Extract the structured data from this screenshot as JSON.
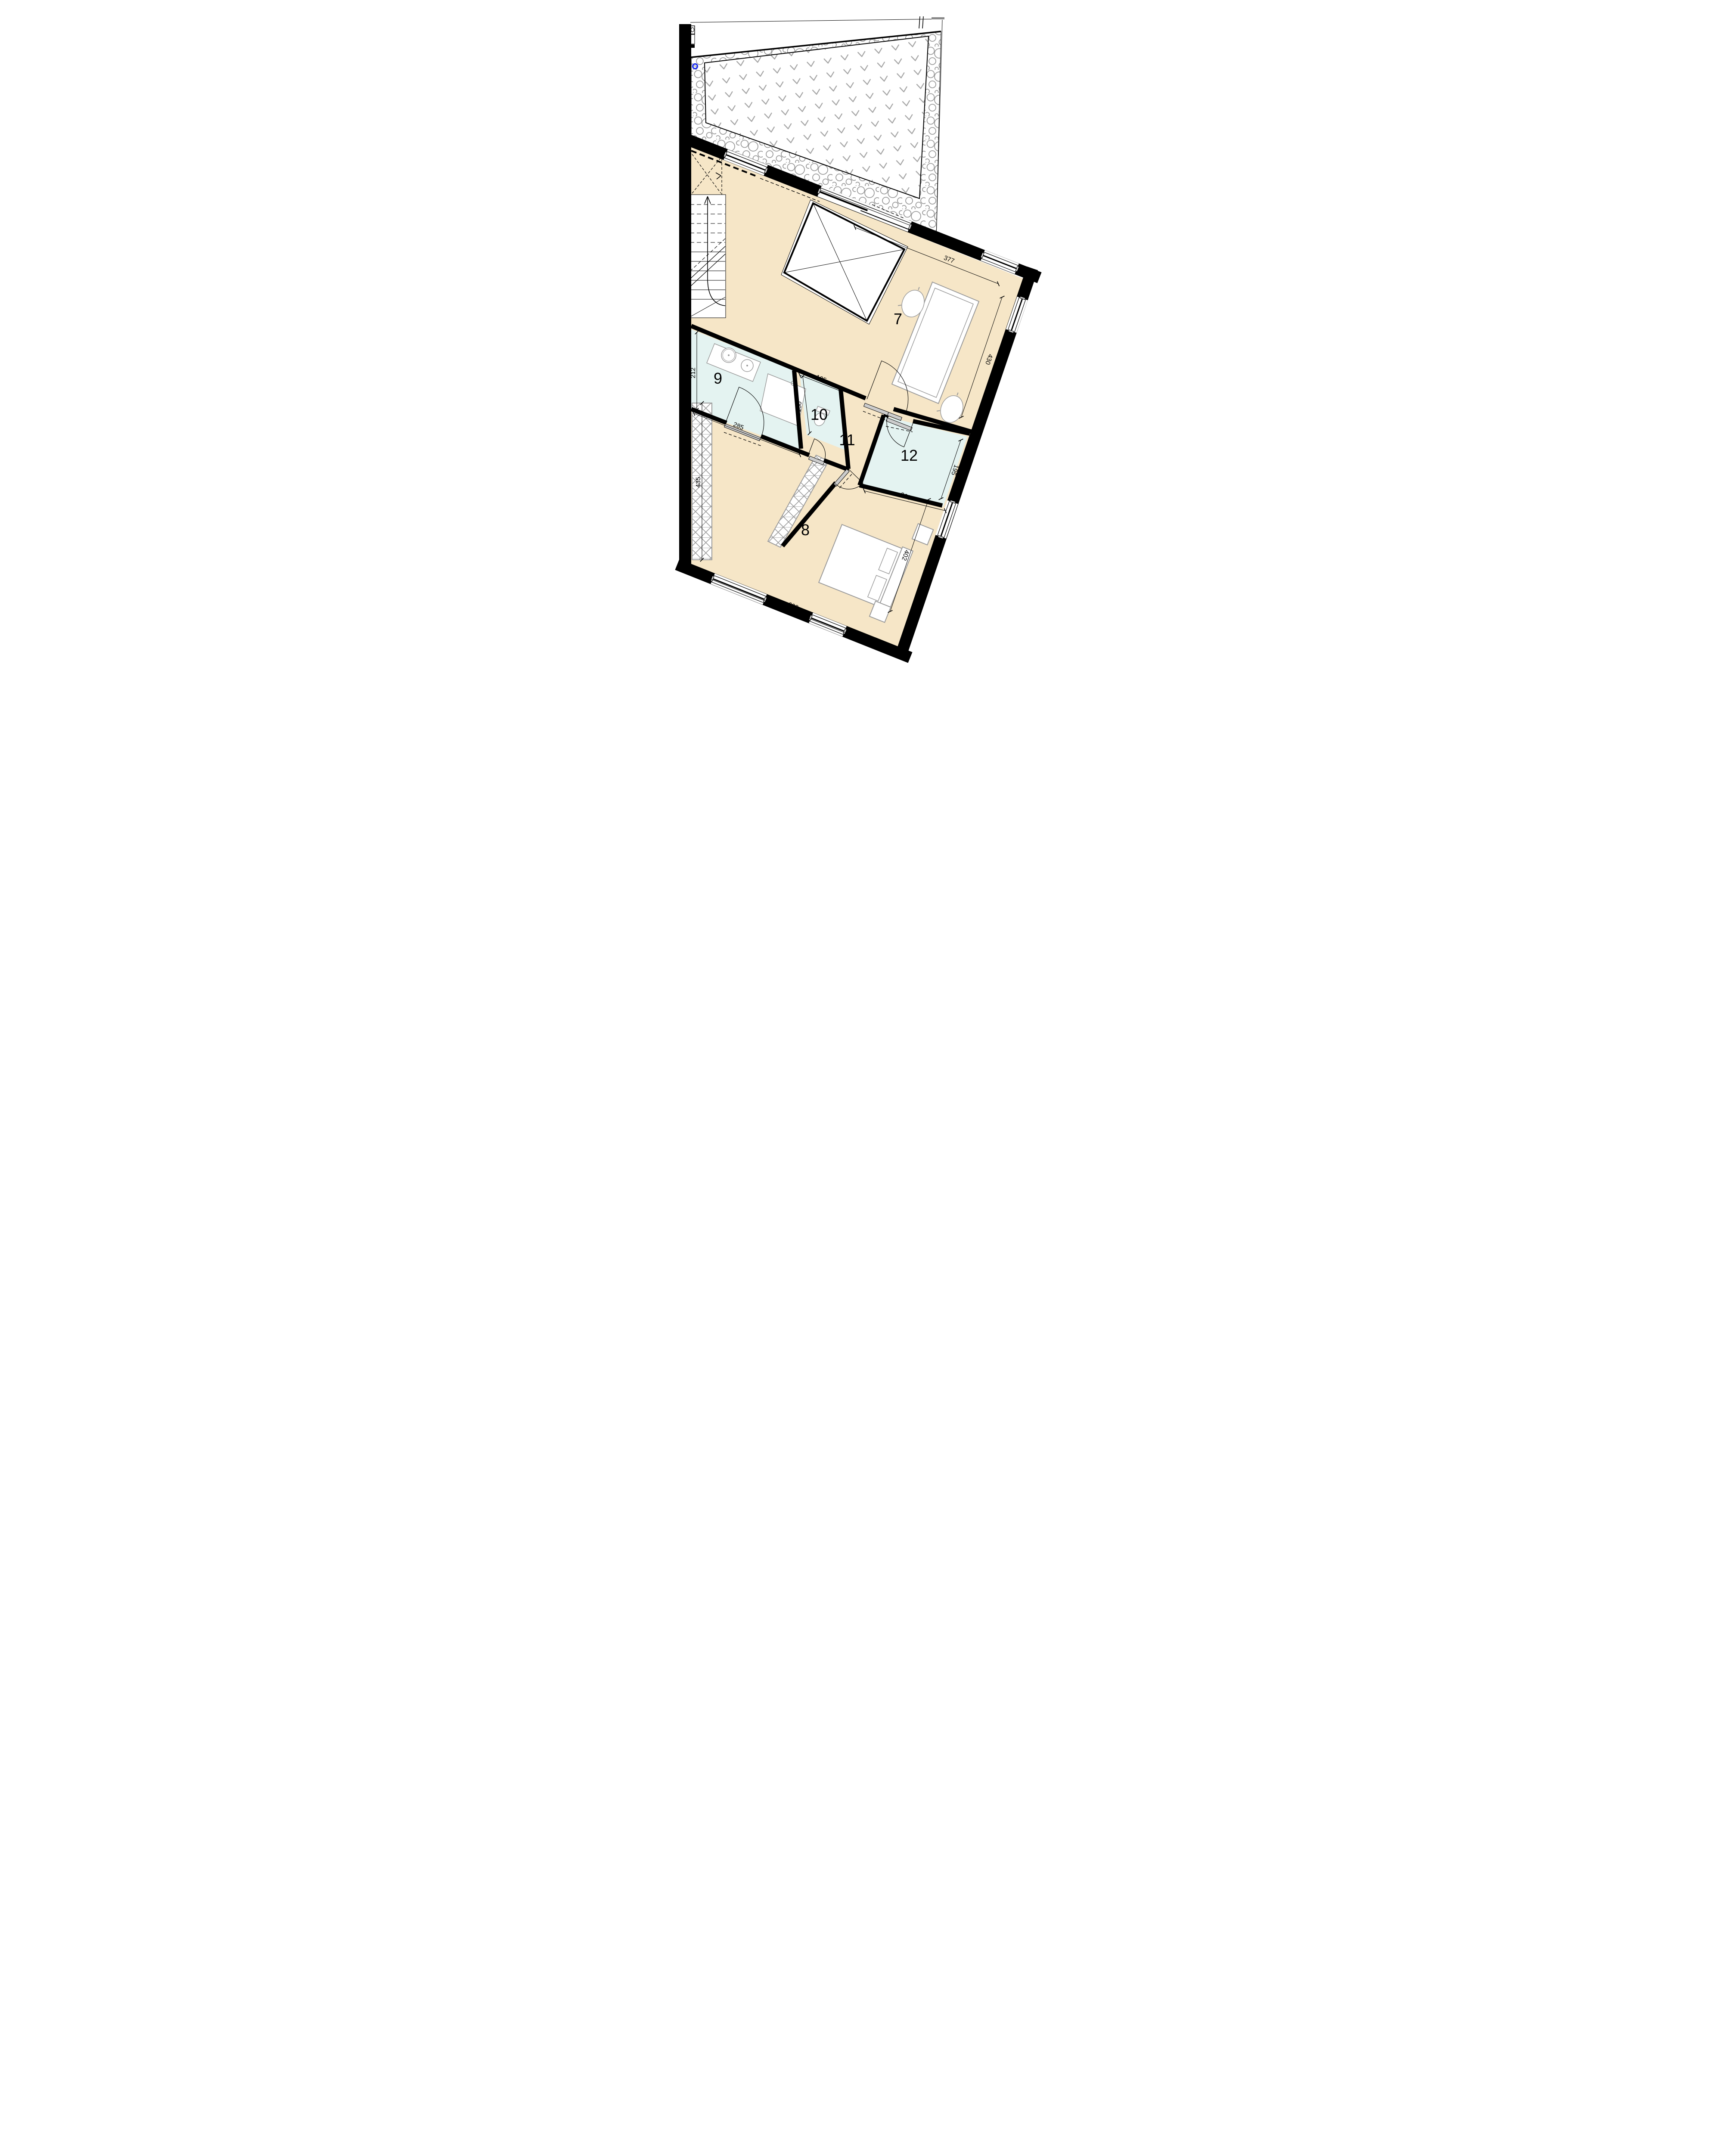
{
  "rooms": {
    "living": {
      "number": "7"
    },
    "bedroom": {
      "number": "8"
    },
    "bathroom": {
      "number": "9"
    },
    "wc": {
      "number": "10"
    },
    "hall": {
      "number": "11"
    },
    "room12": {
      "number": "12"
    }
  },
  "dimensions": {
    "living_width": "377",
    "living_depth": "430",
    "bathroom_depth": "212",
    "bathroom_width": "285",
    "wc_width": "105",
    "wc_depth": "150",
    "wardrobe_length": "435",
    "room12_width": "263",
    "room12_depth": "195",
    "bedroom_width": "609",
    "bedroom_depth": "402"
  },
  "colors": {
    "floor_dry": "#f6e6c7",
    "floor_wet": "#e4f3f1",
    "wall": "#000000",
    "furniture": "#9b9b9b",
    "pattern": "#9b9b9b",
    "marker_blue": "#1a2bee"
  }
}
